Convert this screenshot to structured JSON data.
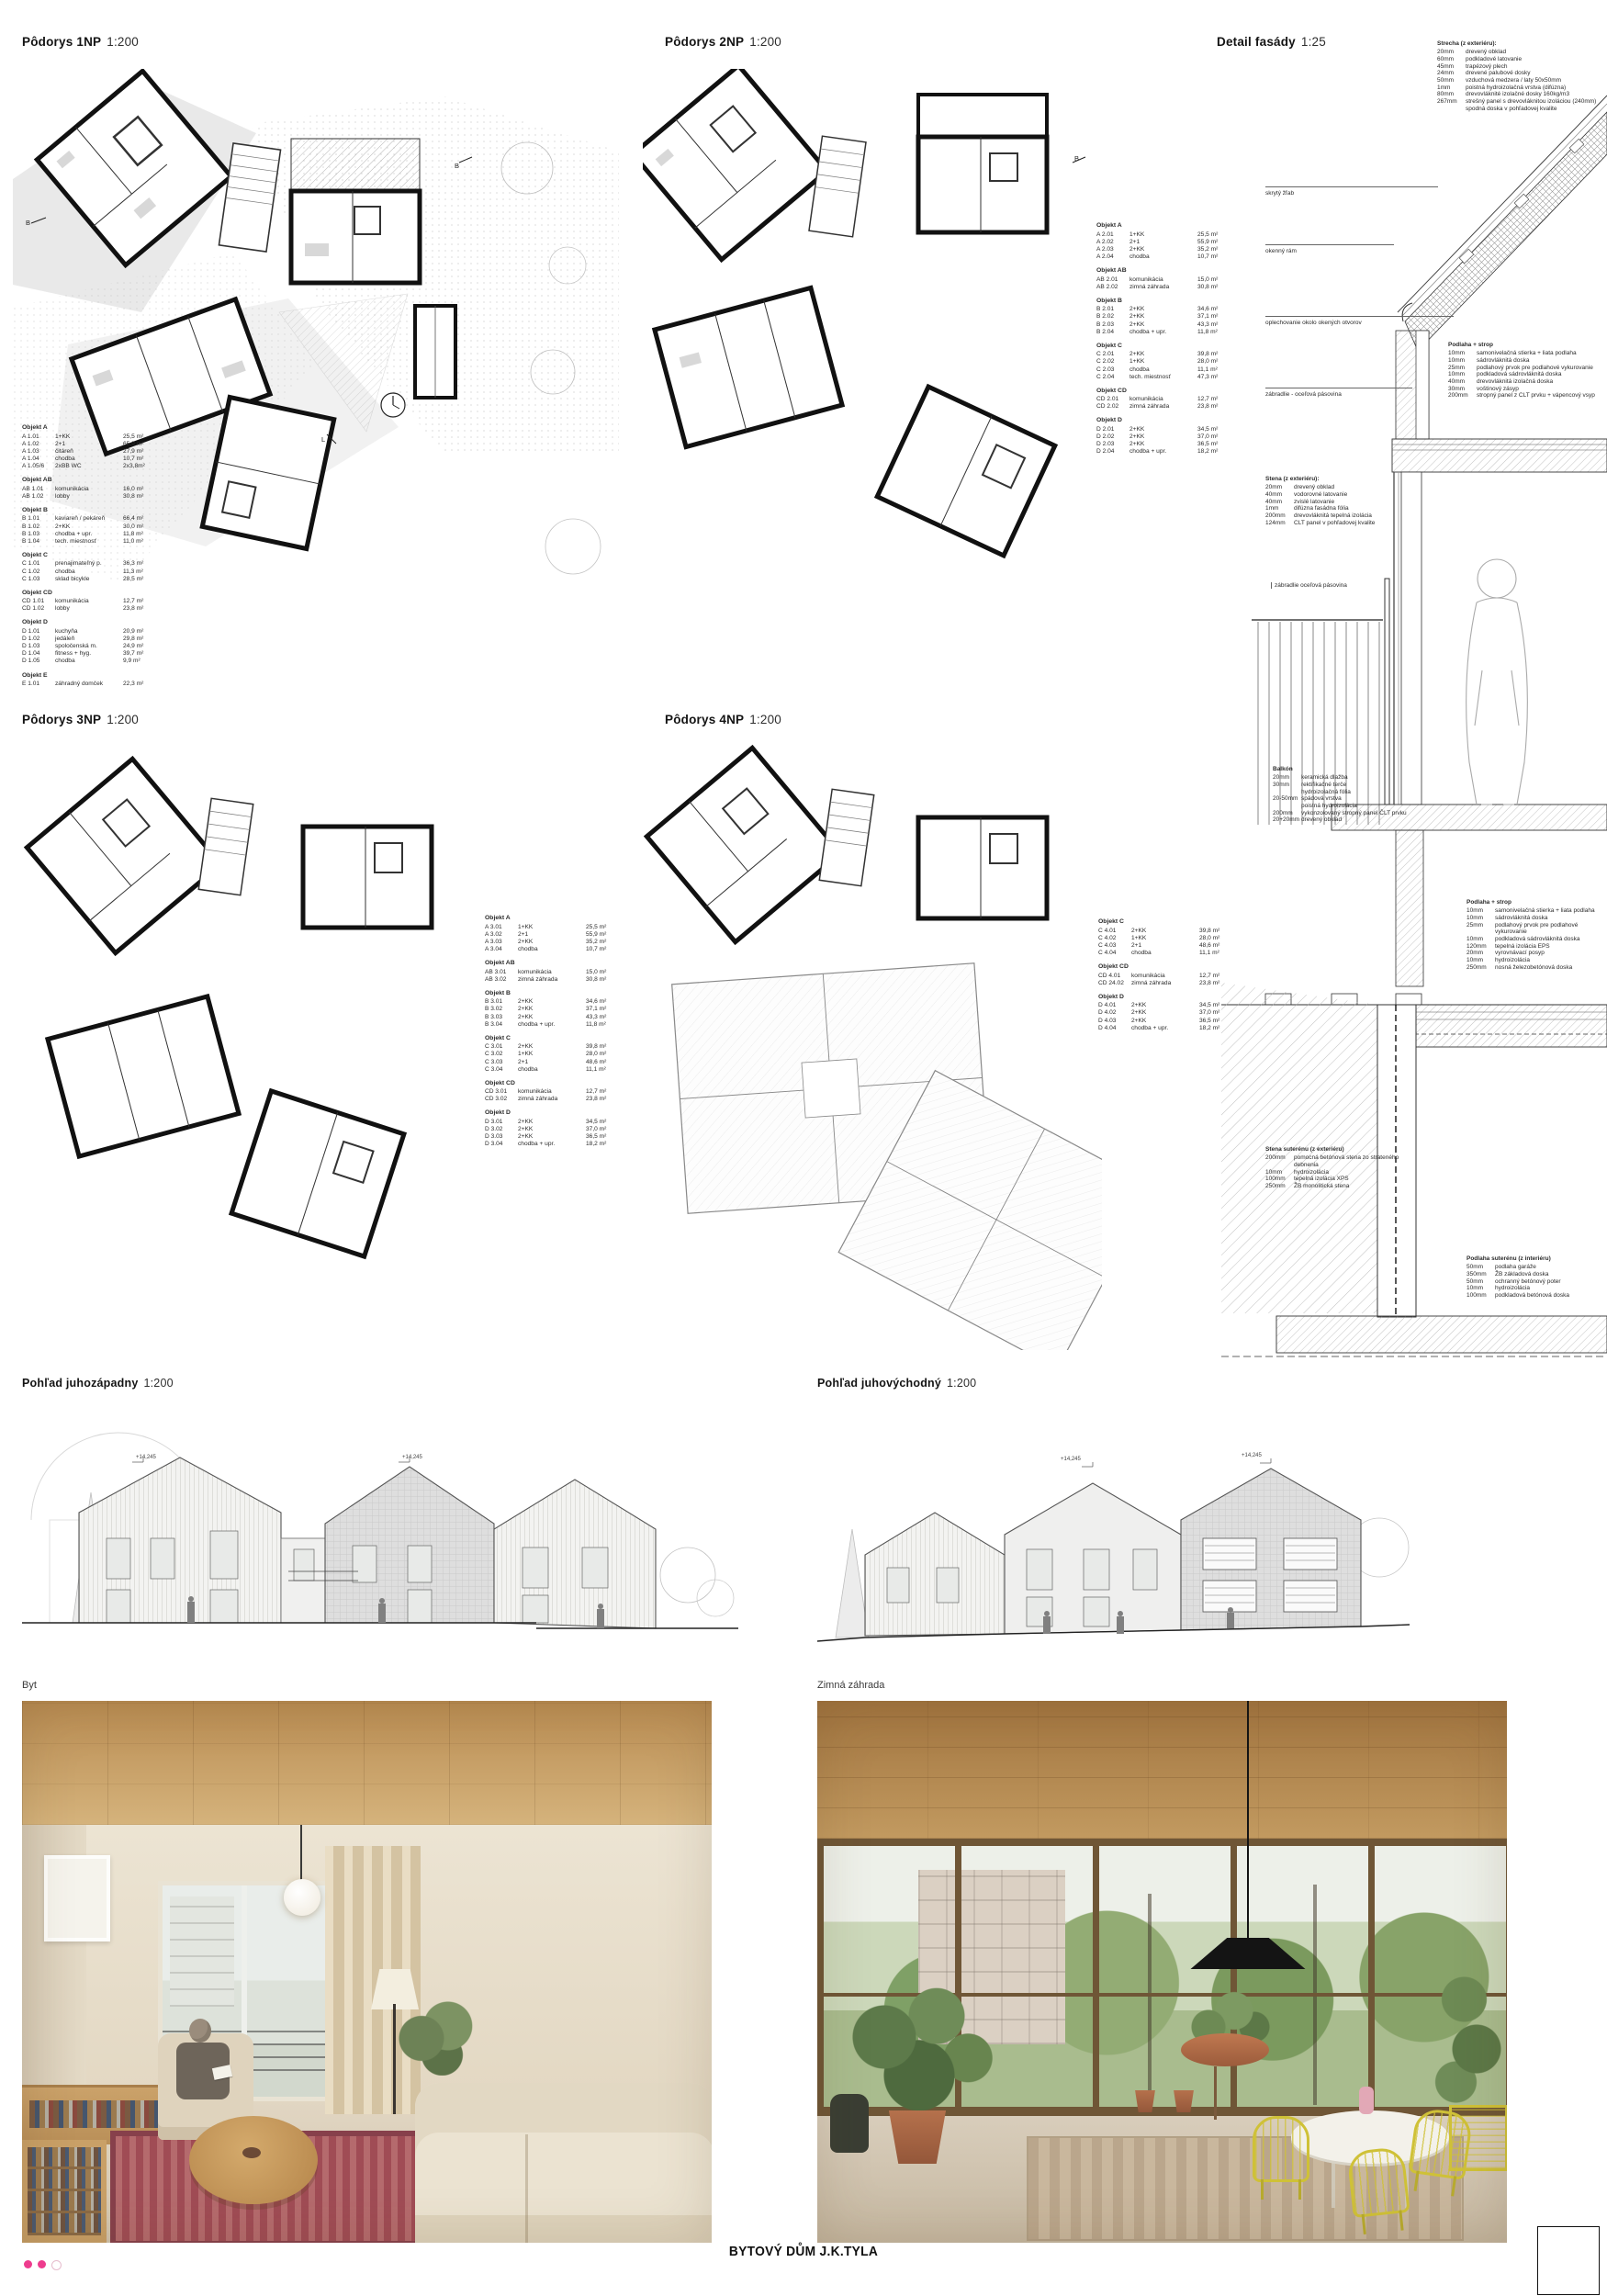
{
  "footer": {
    "title": "BYTOVÝ DŮM J.K.TYLA"
  },
  "colors": {
    "accent_magenta": "#ee3c8e",
    "paper": "#ffffff",
    "ink": "#1a1a1a",
    "wood": "#c9a06b",
    "plan_gray": "#e3e3e3"
  },
  "sections": {
    "plan_1np": {
      "title": "Pôdorys 1NP",
      "scale": "1:200"
    },
    "plan_2np": {
      "title": "Pôdorys 2NP",
      "scale": "1:200"
    },
    "plan_3np": {
      "title": "Pôdorys 3NP",
      "scale": "1:200"
    },
    "plan_4np": {
      "title": "Pôdorys 4NP",
      "scale": "1:200"
    },
    "detail": {
      "title": "Detail fasády",
      "scale": "1:25"
    }
  },
  "elevations": {
    "sw": {
      "title": "Pohľad juhozápadny",
      "scale": "1:200",
      "levels": [
        "+14,245",
        "+14,245"
      ]
    },
    "se": {
      "title": "Pohľad juhovýchodný",
      "scale": "1:200",
      "levels": [
        "+14,245",
        "+14,245"
      ]
    }
  },
  "renders": {
    "flat": {
      "label": "Byt"
    },
    "garden": {
      "label": "Zimná záhrada"
    }
  },
  "section_markers": {
    "b": "B",
    "l": "L"
  },
  "legend_1np": [
    {
      "name": "Objekt A",
      "rows": [
        [
          "A 1.01",
          "1+KK",
          "25,5 m²"
        ],
        [
          "A 1.02",
          "2+1",
          "65,9 m²"
        ],
        [
          "A 1.03",
          "čitáreň",
          "27,9 m²"
        ],
        [
          "A 1.04",
          "chodba",
          "10,7 m²"
        ],
        [
          "A 1.05/6",
          "2xBB WC",
          "2x3,8m²"
        ]
      ]
    },
    {
      "name": "Objekt AB",
      "rows": [
        [
          "AB 1.01",
          "komunikácia",
          "16,0 m²"
        ],
        [
          "AB 1.02",
          "lobby",
          "30,8 m²"
        ]
      ]
    },
    {
      "name": "Objekt B",
      "rows": [
        [
          "B 1.01",
          "kaviareň / pekáreň",
          "66,4 m²"
        ],
        [
          "B 1.02",
          "2+KK",
          "30,0 m²"
        ],
        [
          "B 1.03",
          "chodba + upr.",
          "11,8 m²"
        ],
        [
          "B 1.04",
          "tech. miestnosť",
          "11,0 m²"
        ]
      ]
    },
    {
      "name": "Objekt C",
      "rows": [
        [
          "C 1.01",
          "prenajimateľný p.",
          "36,3 m²"
        ],
        [
          "C 1.02",
          "chodba",
          "11,3 m²"
        ],
        [
          "C 1.03",
          "sklad bicykle",
          "28,5 m²"
        ]
      ]
    },
    {
      "name": "Objekt CD",
      "rows": [
        [
          "CD 1.01",
          "komunikácia",
          "12,7 m²"
        ],
        [
          "CD 1.02",
          "lobby",
          "23,8 m²"
        ]
      ]
    },
    {
      "name": "Objekt D",
      "rows": [
        [
          "D 1.01",
          "kuchyňa",
          "20,9 m²"
        ],
        [
          "D 1.02",
          "jedáleň",
          "29,8 m²"
        ],
        [
          "D 1.03",
          "spoločenská m.",
          "24,9 m²"
        ],
        [
          "D 1.04",
          "fitness + hyg.",
          "39,7 m²"
        ],
        [
          "D 1.05",
          "chodba",
          "9,9 m²"
        ]
      ]
    },
    {
      "name": "Objekt E",
      "rows": [
        [
          "E 1.01",
          "záhradný domček",
          "22,3 m²"
        ]
      ]
    }
  ],
  "legend_2np": [
    {
      "name": "Objekt A",
      "rows": [
        [
          "A 2.01",
          "1+KK",
          "25,5 m²"
        ],
        [
          "A 2.02",
          "2+1",
          "55,9 m²"
        ],
        [
          "A 2.03",
          "2+KK",
          "35,2 m²"
        ],
        [
          "A 2.04",
          "chodba",
          "10,7 m²"
        ]
      ]
    },
    {
      "name": "Objekt AB",
      "rows": [
        [
          "AB 2.01",
          "komunikácia",
          "15,0 m²"
        ],
        [
          "AB 2.02",
          "zimná záhrada",
          "30,8 m²"
        ]
      ]
    },
    {
      "name": "Objekt B",
      "rows": [
        [
          "B 2.01",
          "2+KK",
          "34,6 m²"
        ],
        [
          "B 2.02",
          "2+KK",
          "37,1 m²"
        ],
        [
          "B 2.03",
          "2+KK",
          "43,3 m²"
        ],
        [
          "B 2.04",
          "chodba + upr.",
          "11,8 m²"
        ]
      ]
    },
    {
      "name": "Objekt C",
      "rows": [
        [
          "C 2.01",
          "2+KK",
          "39,8 m²"
        ],
        [
          "C 2.02",
          "1+KK",
          "28,0 m²"
        ],
        [
          "C 2.03",
          "chodba",
          "11,1 m²"
        ],
        [
          "C 2.04",
          "tech. miestnosť",
          "47,3 m²"
        ]
      ]
    },
    {
      "name": "Objekt CD",
      "rows": [
        [
          "CD 2.01",
          "komunikácia",
          "12,7 m²"
        ],
        [
          "CD 2.02",
          "zimná záhrada",
          "23,8 m²"
        ]
      ]
    },
    {
      "name": "Objekt D",
      "rows": [
        [
          "D 2.01",
          "2+KK",
          "34,5 m²"
        ],
        [
          "D 2.02",
          "2+KK",
          "37,0 m²"
        ],
        [
          "D 2.03",
          "2+KK",
          "36,5 m²"
        ],
        [
          "D 2.04",
          "chodba + upr.",
          "18,2 m²"
        ]
      ]
    }
  ],
  "legend_3np": [
    {
      "name": "Objekt A",
      "rows": [
        [
          "A 3.01",
          "1+KK",
          "25,5 m²"
        ],
        [
          "A 3.02",
          "2+1",
          "55,9 m²"
        ],
        [
          "A 3.03",
          "2+KK",
          "35,2 m²"
        ],
        [
          "A 3.04",
          "chodba",
          "10,7 m²"
        ]
      ]
    },
    {
      "name": "Objekt AB",
      "rows": [
        [
          "AB 3.01",
          "komunikácia",
          "15,0 m²"
        ],
        [
          "AB 3.02",
          "zimná záhrada",
          "30,8 m²"
        ]
      ]
    },
    {
      "name": "Objekt B",
      "rows": [
        [
          "B 3.01",
          "2+KK",
          "34,6 m²"
        ],
        [
          "B 3.02",
          "2+KK",
          "37,1 m²"
        ],
        [
          "B 3.03",
          "2+KK",
          "43,3 m²"
        ],
        [
          "B 3.04",
          "chodba + upr.",
          "11,8 m²"
        ]
      ]
    },
    {
      "name": "Objekt C",
      "rows": [
        [
          "C 3.01",
          "2+KK",
          "39,8 m²"
        ],
        [
          "C 3.02",
          "1+KK",
          "28,0 m²"
        ],
        [
          "C 3.03",
          "2+1",
          "48,6 m²"
        ],
        [
          "C 3.04",
          "chodba",
          "11,1 m²"
        ]
      ]
    },
    {
      "name": "Objekt CD",
      "rows": [
        [
          "CD 3.01",
          "komunikácia",
          "12,7 m²"
        ],
        [
          "CD 3.02",
          "zimná záhrada",
          "23,8 m²"
        ]
      ]
    },
    {
      "name": "Objekt D",
      "rows": [
        [
          "D 3.01",
          "2+KK",
          "34,5 m²"
        ],
        [
          "D 3.02",
          "2+KK",
          "37,0 m²"
        ],
        [
          "D 3.03",
          "2+KK",
          "36,5 m²"
        ],
        [
          "D 3.04",
          "chodba + upr.",
          "18,2 m²"
        ]
      ]
    }
  ],
  "legend_4np": [
    {
      "name": "Objekt C",
      "rows": [
        [
          "C 4.01",
          "2+KK",
          "39,8 m²"
        ],
        [
          "C 4.02",
          "1+KK",
          "28,0 m²"
        ],
        [
          "C 4.03",
          "2+1",
          "48,6 m²"
        ],
        [
          "C 4.04",
          "chodba",
          "11,1 m²"
        ]
      ]
    },
    {
      "name": "Objekt CD",
      "rows": [
        [
          "CD 4.01",
          "komunikácia",
          "12,7 m²"
        ],
        [
          "CD 24.02",
          "zimná záhrada",
          "23,8 m²"
        ]
      ]
    },
    {
      "name": "Objekt D",
      "rows": [
        [
          "D 4.01",
          "2+KK",
          "34,5 m²"
        ],
        [
          "D 4.02",
          "2+KK",
          "37,0 m²"
        ],
        [
          "D 4.03",
          "2+KK",
          "36,5 m²"
        ],
        [
          "D 4.04",
          "chodba + upr.",
          "18,2 m²"
        ]
      ]
    }
  ],
  "detail_blocks": {
    "strecha": {
      "title": "Strecha (z exteriéru):",
      "rows": [
        [
          "20mm",
          "drevený obklad"
        ],
        [
          "60mm",
          "podkladové latovanie"
        ],
        [
          "45mm",
          "trapézový plech"
        ],
        [
          "24mm",
          "drevené palubové dosky"
        ],
        [
          "50mm",
          "vzduchová medzera / laty 50x50mm"
        ],
        [
          "1mm",
          "poistná hydroizolačná vrstva (difúzna)"
        ],
        [
          "80mm",
          "drevovláknité izolačné dosky 160kg/m3"
        ],
        [
          "267mm",
          "strešný panel s drevovláknitou izoláciou (240mm) spodná doska v pohľadovej kvalite"
        ]
      ]
    },
    "podlaha_strop_1": {
      "title": "Podlaha + strop",
      "rows": [
        [
          "10mm",
          "samonivelačná stierka + liata podlaha"
        ],
        [
          "10mm",
          "sádrovláknitá doska"
        ],
        [
          "25mm",
          "podlahový prvok pre podlahové vykurovanie"
        ],
        [
          "10mm",
          "podkladová sádrovláknitá doska"
        ],
        [
          "40mm",
          "drevovláknitá izolačná doska"
        ],
        [
          "30mm",
          "voštinový zásyp"
        ],
        [
          "200mm",
          "stropný panel z CLT prvku + vápencový vsyp"
        ]
      ]
    },
    "stena": {
      "title": "Stena (z exteriéru):",
      "rows": [
        [
          "20mm",
          "drevený obklad"
        ],
        [
          "40mm",
          "vodorovné latovanie"
        ],
        [
          "40mm",
          "zvislé latovanie"
        ],
        [
          "1mm",
          "difúzna fasádna fólia"
        ],
        [
          "200mm",
          "drevovláknitá tepelná izolácia"
        ],
        [
          "124mm",
          "CLT panel v pohľadovej kvalite"
        ]
      ]
    },
    "balkon": {
      "title": "Balkón",
      "rows": [
        [
          "20mm",
          "keramická dlažba"
        ],
        [
          "30mm",
          "rektifikačné terče"
        ],
        [
          "",
          "hydroizolačná fólia"
        ],
        [
          "20-50mm",
          "spádová vrstva"
        ],
        [
          "",
          "poistná hydroizolácia"
        ],
        [
          "200mm",
          "vykonzolovaný stropný panel ČLT prvku"
        ],
        [
          "20+20mm",
          "drevený obklad"
        ]
      ]
    },
    "podlaha_strop_2": {
      "title": "Podlaha + strop",
      "rows": [
        [
          "10mm",
          "samonivelačná stierka + liata podlaha"
        ],
        [
          "10mm",
          "sádrovláknitá doska"
        ],
        [
          "25mm",
          "podlahový prvok pre podlahové vykurovanie"
        ],
        [
          "10mm",
          "podkladová sádrovláknitá doska"
        ],
        [
          "120mm",
          "tepelná izolácia EPS"
        ],
        [
          "20mm",
          "vyrovnávací posyp"
        ],
        [
          "10mm",
          "hydroizolácia"
        ],
        [
          "250mm",
          "nosná železobetónová doska"
        ]
      ]
    },
    "stena_suterenu": {
      "title": "Stena suterénu (z exteriéru)",
      "rows": [
        [
          "200mm",
          "pomocná betónová stena zo strateného debnenia"
        ],
        [
          "10mm",
          "hydroizolácia"
        ],
        [
          "100mm",
          "tepelná izolácia XPS"
        ],
        [
          "250mm",
          "ŽB monolitická stena"
        ]
      ]
    },
    "podlaha_suterenu": {
      "title": "Podlaha suterénu (z interiéru)",
      "rows": [
        [
          "50mm",
          "podlaha garáže"
        ],
        [
          "350mm",
          "ŽB základová doska"
        ],
        [
          "50mm",
          "ochranný betónový poter"
        ],
        [
          "10mm",
          "hydroizolácia"
        ],
        [
          "100mm",
          "podkladová betónová doska"
        ]
      ]
    }
  },
  "detail_callouts": {
    "zlab": "skrytý žľab",
    "ram": "okenný rám",
    "oplechovanie": "oplechovanie okolo okených otvorov",
    "zabradlie1": "zábradlie - oceľová pásovina",
    "zabradlie2": "zábradlie oceľová pásovina"
  }
}
